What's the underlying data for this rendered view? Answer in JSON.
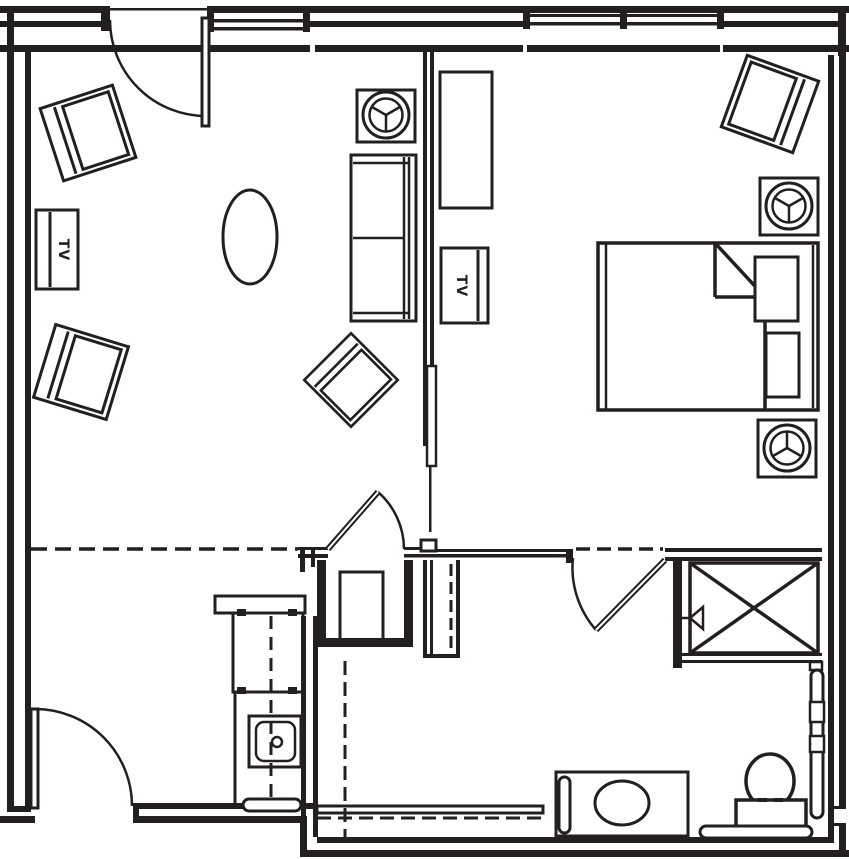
{
  "document": {
    "type": "architectural-floor-plan",
    "width_px": 849,
    "height_px": 859
  },
  "colors": {
    "line": "#231f20",
    "background": "#ffffff"
  },
  "labels": {
    "tv": "TV"
  },
  "fixtures": {
    "living_area": [
      "armchair-top-left",
      "armchair-left",
      "armchair-center-diamond",
      "tv-cabinet-left-wall",
      "oval-coffee-table",
      "sofa-two-cushion",
      "side-table-with-lamp"
    ],
    "bedroom": [
      "bed-with-turned-sheet-and-two-pillows",
      "armchair-corner",
      "nightstand-with-lamp-top",
      "nightstand-with-lamp-bottom",
      "dresser",
      "tv-cabinet-partition"
    ],
    "kitchenette": [
      "pass-through-counter",
      "base-cabinet",
      "sink-with-drain",
      "towel-bar",
      "dashed-counter-centerline"
    ],
    "bathroom": [
      "vanity-with-oval-sink",
      "vertical-grab-bar-vanity",
      "toilet-with-tank",
      "grab-bar-behind-toilet",
      "grab-bar-right-wall",
      "shower-curtain-dashed-lines",
      "shower-ledge"
    ],
    "closets": [
      "utility-closet-with-fixture",
      "linen-closet-x-with-arrow"
    ],
    "doors": [
      "entry-door-top-wall",
      "entry-door-bottom-left",
      "closet-swing-door",
      "bathroom-swing-door",
      "pocket-door-partition"
    ],
    "windows": [
      "window-top-left",
      "window-top-center",
      "window-top-right-band"
    ]
  }
}
